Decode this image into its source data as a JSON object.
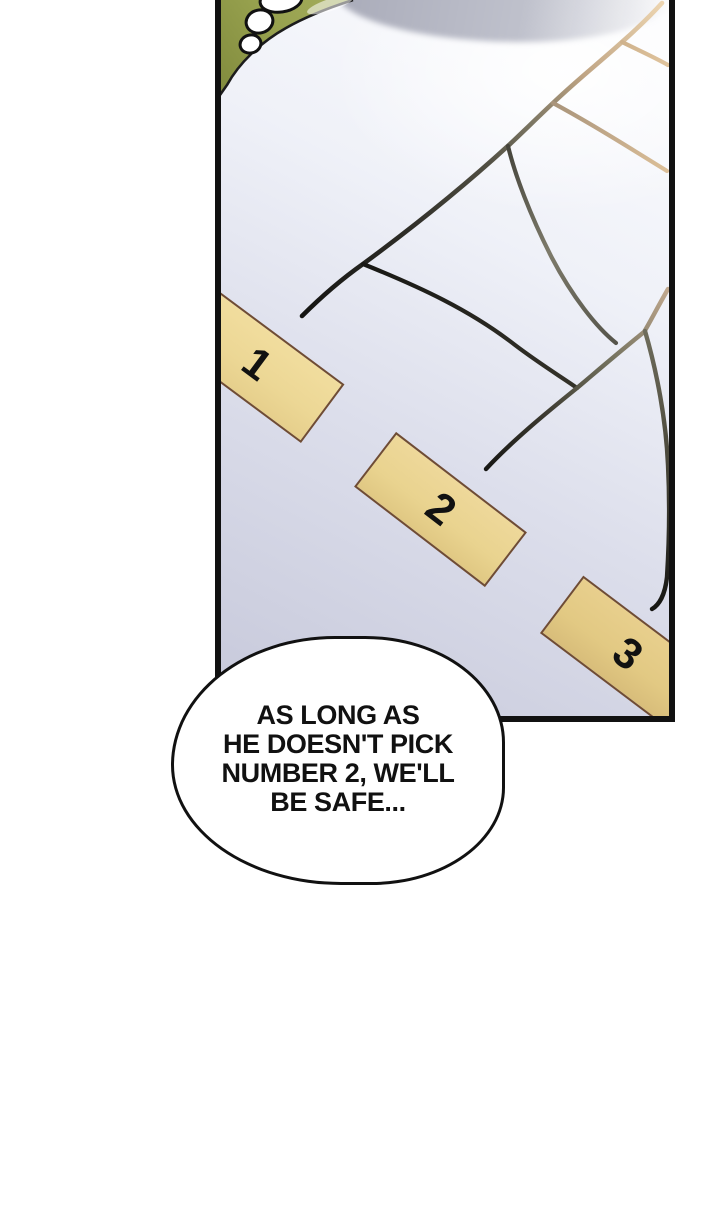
{
  "panel": {
    "cards": [
      {
        "label": "1"
      },
      {
        "label": "2"
      },
      {
        "label": "3"
      }
    ]
  },
  "speech_bubble": {
    "lines": [
      "AS LONG AS",
      "HE DOESN'T PICK",
      "NUMBER 2, WE'LL",
      "BE SAFE..."
    ]
  },
  "colors": {
    "ink": "#111111",
    "panel_lavender": "#c6c8da",
    "card_fill": "#ecd795",
    "card_border": "#6f4c34",
    "tan_line": "#dcbf98",
    "olive_green": "#97a14e",
    "cloud_gray": "#a9abb9",
    "bubble_fill": "#ffffff"
  }
}
